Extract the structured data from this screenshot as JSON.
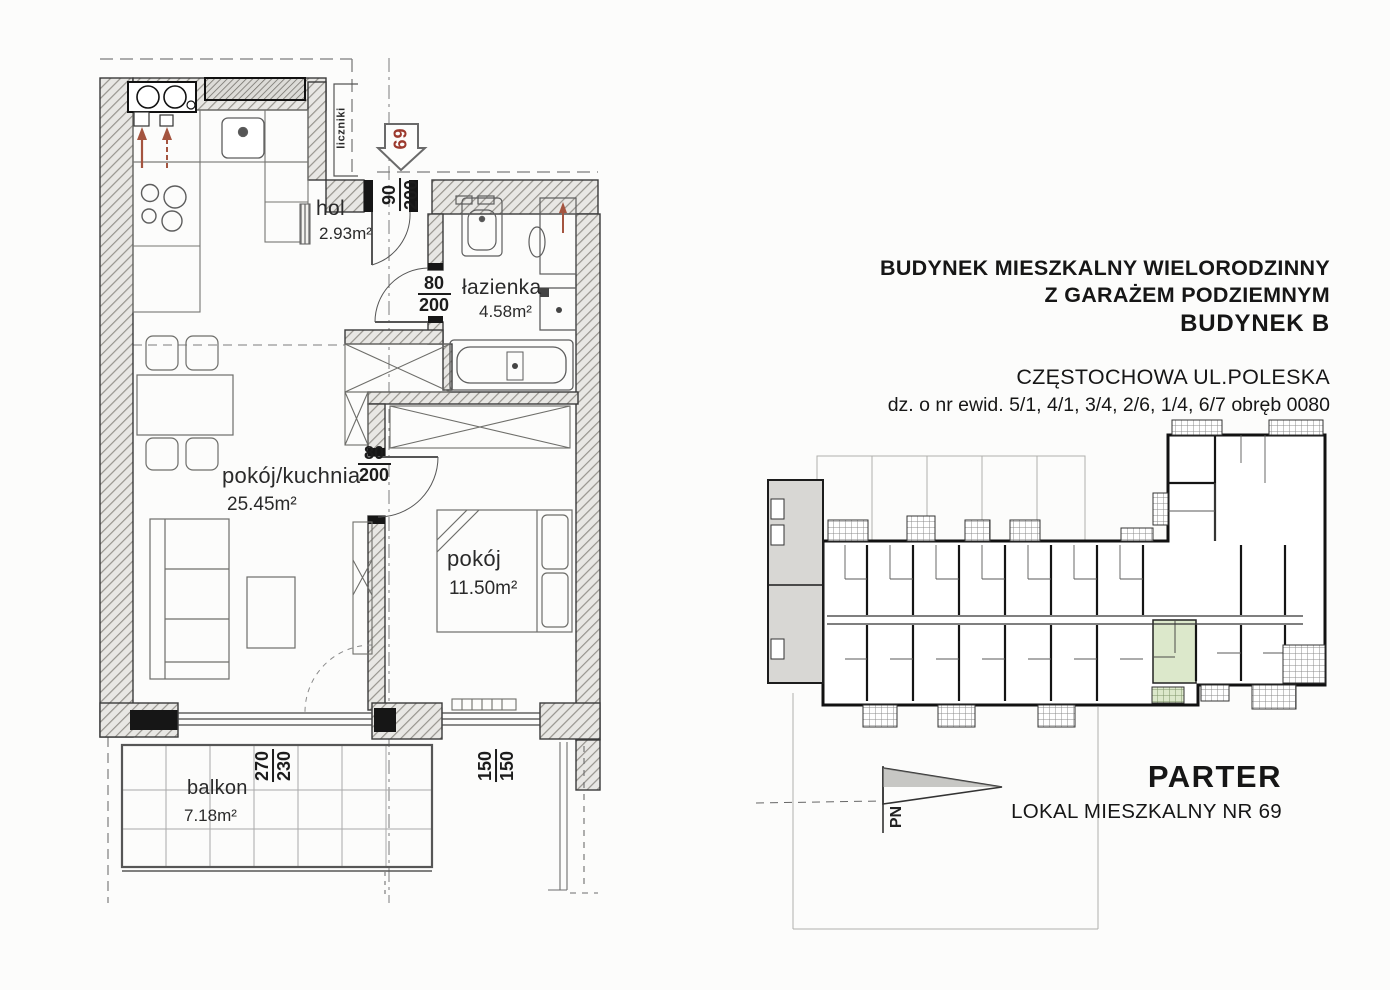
{
  "document": {
    "background": "#fcfcfb"
  },
  "floor_plan": {
    "unit_number": "69",
    "meters_label": "liczniki",
    "rooms": [
      {
        "name": "hol",
        "area": "2.93m²"
      },
      {
        "name": "łazienka",
        "area": "4.58m²"
      },
      {
        "name": "pokój/kuchnia",
        "area": "25.45m²"
      },
      {
        "name": "pokój",
        "area": "11.50m²"
      },
      {
        "name": "balkon",
        "area": "7.18m²"
      }
    ],
    "dimensions": {
      "entrance_door": {
        "width": "90",
        "height": "200"
      },
      "bathroom_door": {
        "width": "80",
        "height": "200"
      },
      "bedroom_door": {
        "width": "80",
        "height": "200"
      },
      "living_window": {
        "width": "270",
        "height": "230"
      },
      "bedroom_window": {
        "width": "150",
        "height": "150"
      }
    }
  },
  "title_block": {
    "line1": "BUDYNEK MIESZKALNY WIELORODZINNY",
    "line2": "Z GARAŻEM PODZIEMNYM",
    "line3": "BUDYNEK B",
    "address": "CZĘSTOCHOWA UL.POLESKA",
    "parcels": "dz. o nr ewid. 5/1, 4/1, 3/4, 2/6, 1/4, 6/7 obręb 0080"
  },
  "footer": {
    "floor_label": "PARTER",
    "unit_label": "LOKAL MIESZKALNY NR 69",
    "north_label": "PN"
  },
  "colors": {
    "highlight": "#dce8cb",
    "marker_red": "#9c3a2e",
    "wall_hatch": "#97948e"
  }
}
